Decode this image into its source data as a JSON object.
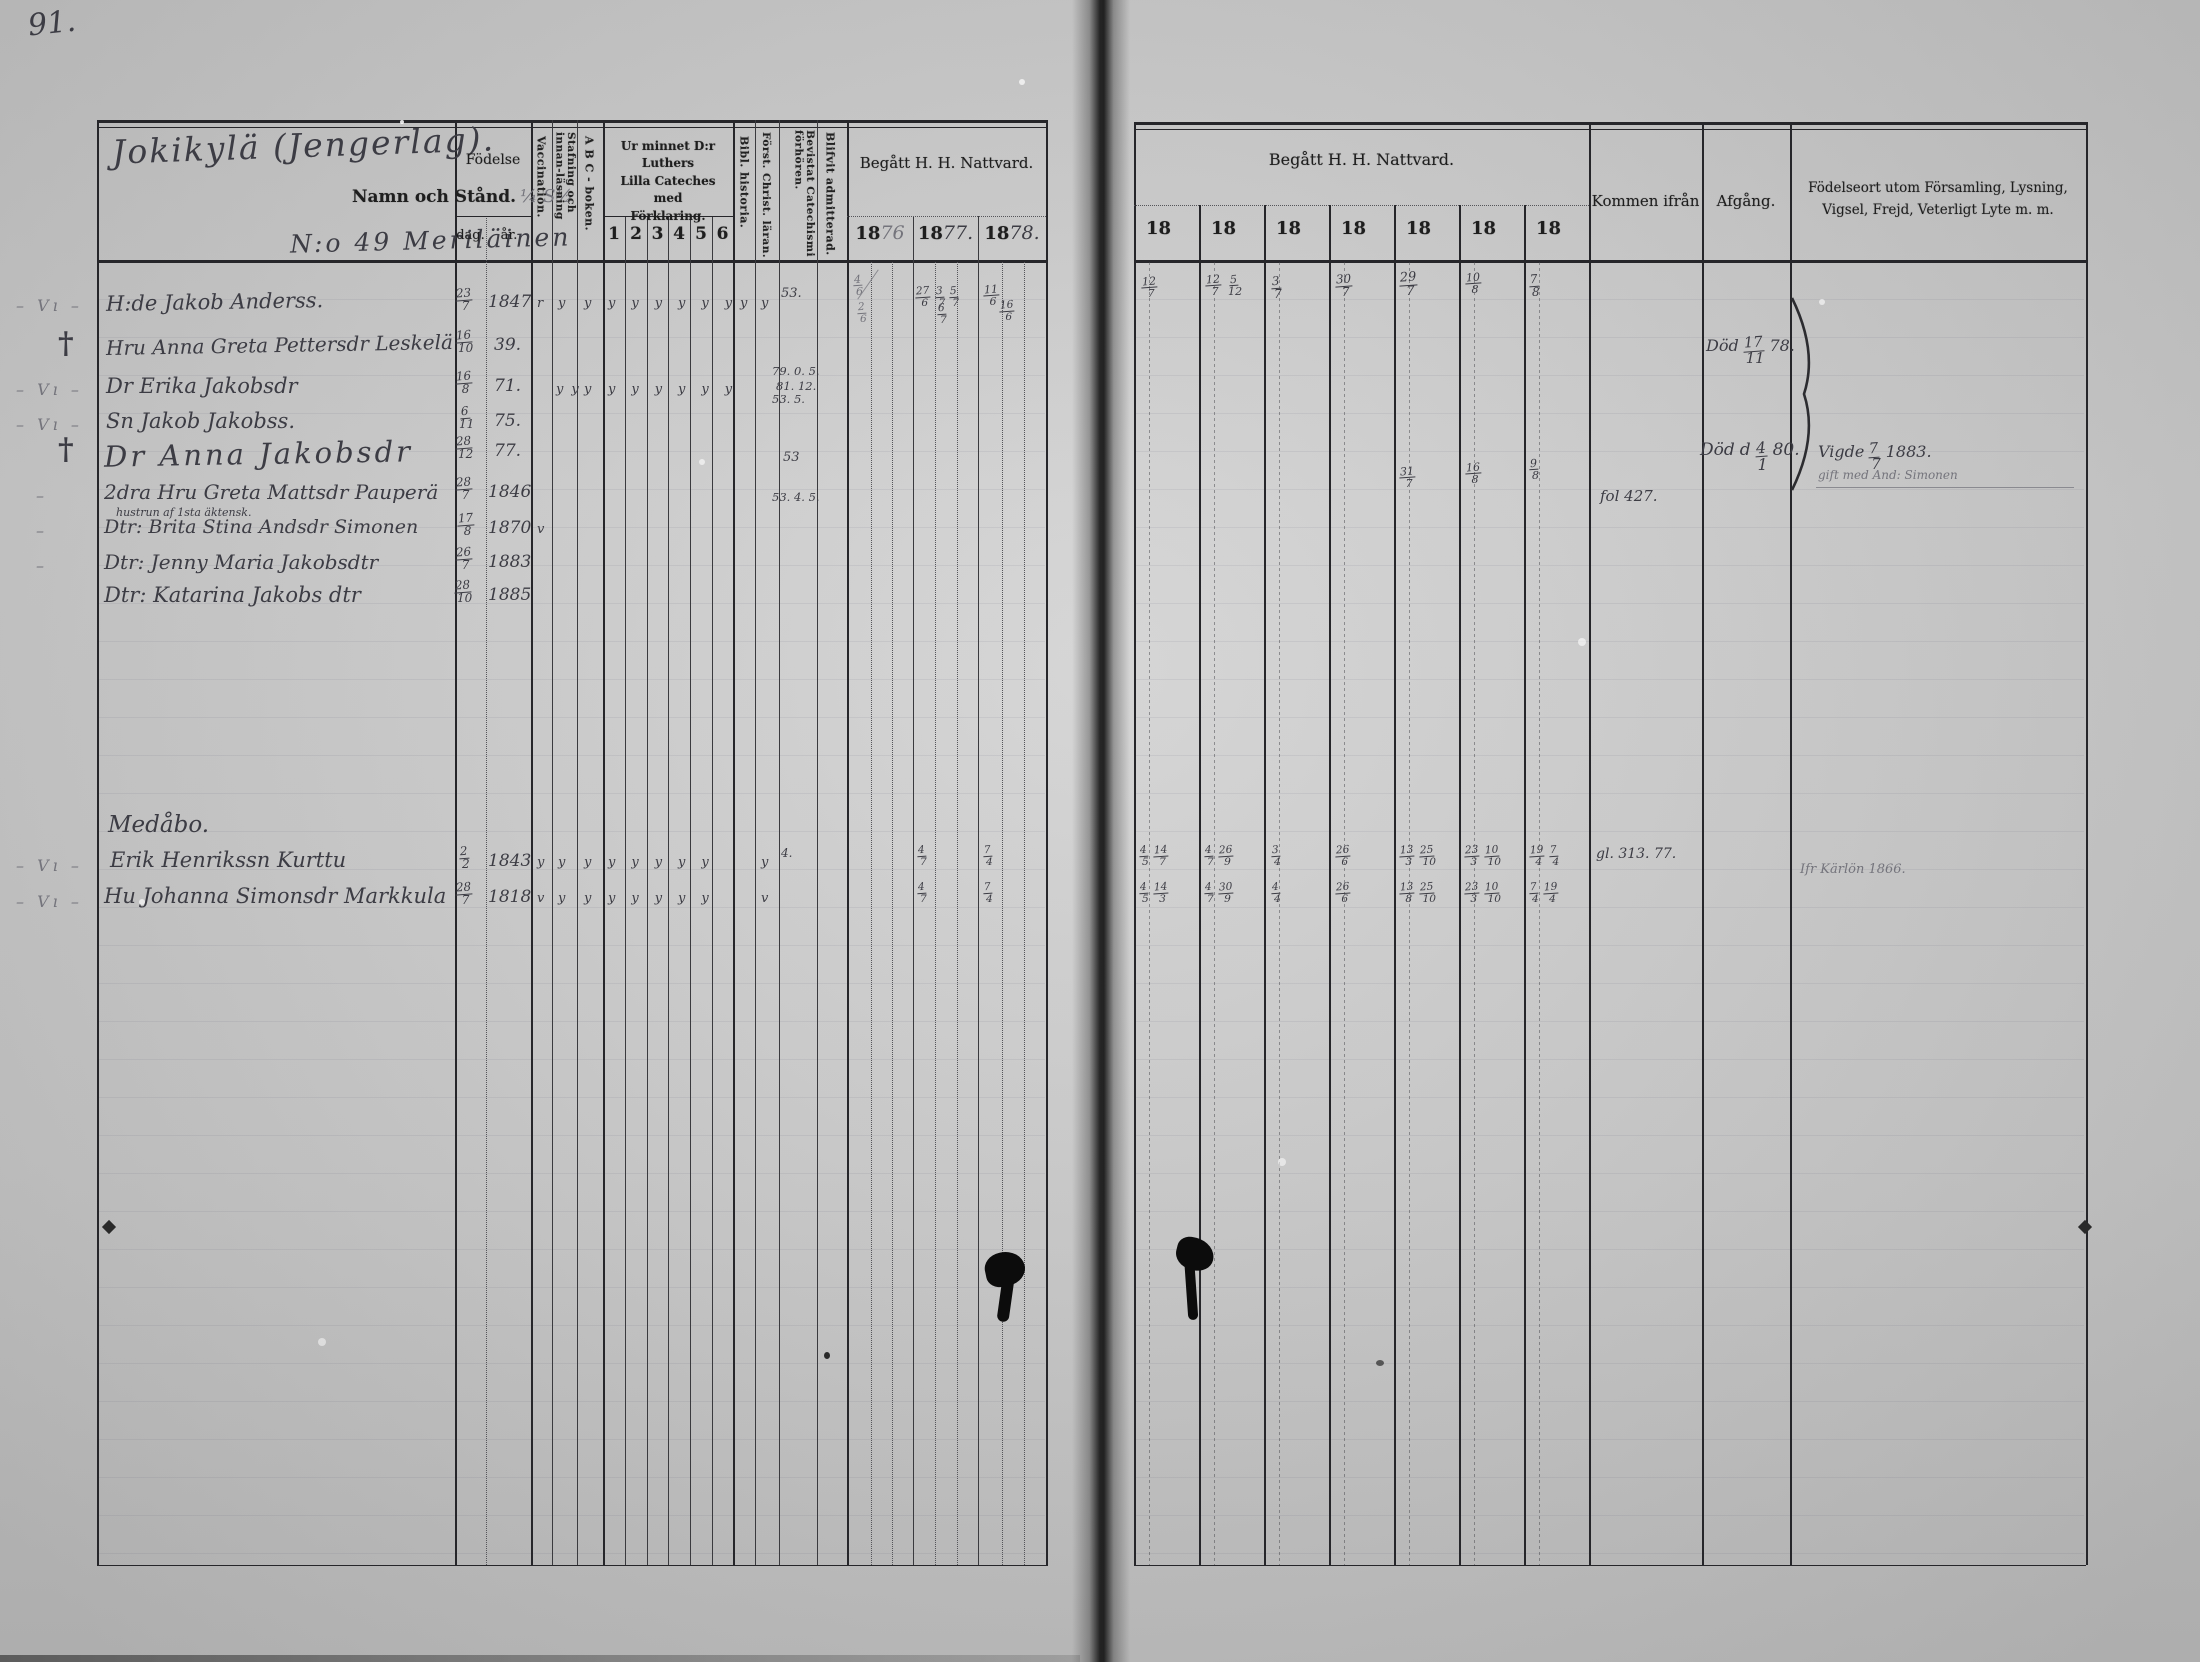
{
  "page_number": "91.",
  "colors": {
    "ink": "#3c3c44",
    "pencil": "#74747c",
    "paper": "#d0d0d0"
  },
  "left_page": {
    "title_handwritten": "Jokikylä (Jengerlag).",
    "header": {
      "name_label": "Namn och Stånd.",
      "name_annotation": "¼  S½",
      "series_handwritten": "N:o 49  Meriläinen",
      "fodelse": "Födelse",
      "dag": "dag.",
      "ar": "år.",
      "vaccination": "Vaccination.",
      "stafning": "Stafning och innan-läsning",
      "abc": "A B C - boken.",
      "cateches_line1": "Ur minnet D:r Luthers",
      "cateches_line2": "Lilla  Cateches  med",
      "cateches_line3": "Förklaring.",
      "catnums": {
        "c1": "1",
        "c2": "2",
        "c3": "3",
        "c4": "4",
        "c5": "5",
        "c6": "6"
      },
      "bibl": "Bibl.  historia.",
      "forst": "Först. Christ. läran.",
      "bevistat": "Bevistat Catechismi förhören.",
      "admitterad": "Blifvit admitterad.",
      "nattvard": "Begått  H.  H.  Nattvard.",
      "years": {
        "y1": {
          "printed": "18",
          "hand": "76"
        },
        "y2": {
          "printed": "18",
          "hand": "77."
        },
        "y3": {
          "printed": "18",
          "hand": "78."
        }
      }
    },
    "rows": [
      {
        "margin": "– Vı –",
        "name": "H:de Jakob Anderss.",
        "dag": "23/7",
        "ar": "1847",
        "vacc": "r",
        "stafn": "y",
        "abc": "y",
        "cat": "yyyyyy",
        "bibl": "y",
        "forst": "y",
        "bevistat": "53.",
        "n76": "4/6",
        "n77": "27/6 3/7 5/7",
        "n78": "11/6"
      },
      {
        "margin": "†",
        "name": "Hru Anna Greta Pettersdr Leskelä",
        "dag": "16/10",
        "ar": "39.",
        "n76": "2/6",
        "n77": "6/7",
        "n78": "16/6"
      },
      {
        "margin": "– Vı –",
        "name": "Dr Erika Jakobsdr",
        "dag": "16/8",
        "ar": "71.",
        "stafn": "yy",
        "abc": "y",
        "cat": "yyyyyy",
        "bevistat": "79. 0. 5.",
        "bevistat2": "81. 12.",
        "bevistat3": "53. 5."
      },
      {
        "margin": "– Vı –",
        "name": "Sn Jakob Jakobss.",
        "dag": "6/11",
        "ar": "75."
      },
      {
        "margin": "†",
        "name": "Dr Anna Jakobsdr",
        "dag": "28/12",
        "ar": "77.",
        "bevistat": "53"
      },
      {
        "margin": "–",
        "name": "2dra Hru Greta Mattsdr Pauperä",
        "note": "hustrun af 1sta äktensk.",
        "dag": "28/7",
        "ar": "1846",
        "bevistat": "53. 4. 5."
      },
      {
        "margin": "–",
        "name": "Dtr: Brita Stina Andsdr Simonen",
        "dag": "17/8",
        "ar": "1870",
        "vacc": "v"
      },
      {
        "margin": "–",
        "name": "Dtr: Jenny Maria Jakobsdtr",
        "dag": "26/7",
        "ar": "1883"
      },
      {
        "margin": "",
        "name": "Dtr: Katarina Jakobs dtr",
        "dag": "28/10",
        "ar": "1885"
      }
    ],
    "section_handwritten": "Medåbo.",
    "rows2": [
      {
        "margin": "– Vı –",
        "name": "Erik Henrikssn Kurttu",
        "dag": "2/2",
        "ar": "1843",
        "vacc": "y",
        "stafn": "y",
        "abc": "y",
        "cat": "yyyyy",
        "forst": "y",
        "bevistat": "4.",
        "n77": "4/7",
        "n78": "7/4"
      },
      {
        "margin": "– Vı –",
        "name": "Hu Johanna Simonsdr Markkula",
        "dag": "28/7",
        "ar": "1818",
        "vacc": "v",
        "stafn": "y",
        "abc": "y",
        "cat": "yyyyy",
        "forst": "v",
        "n77": "4/7",
        "n78": "7/4"
      }
    ]
  },
  "right_page": {
    "header": {
      "nattvard": "Begått  H.  H.  Nattvard.",
      "cols": {
        "c1": "18",
        "c2": "18",
        "c3": "18",
        "c4": "18",
        "c5": "18",
        "c6": "18",
        "c7": "18"
      },
      "kommen": "Kommen ifrån",
      "afgang": "Afgång.",
      "fodelseort_line1": "Födelseort utom Församling, Lysning,",
      "fodelseort_line2": "Vigsel, Frejd, Veterligt Lyte m. m."
    },
    "r1": {
      "c1": "12/7",
      "c2": "12/7 5/12",
      "c3": "3/7",
      "c4": "30/7",
      "c5": "29/7",
      "c6": "10/8",
      "c7": "7/8"
    },
    "r6": {
      "c5": "31/7",
      "c6": "16/8",
      "c7": "9/8"
    },
    "r10": {
      "c1": "4/5 14/7",
      "c2": "4/7 26/9",
      "c3": "3/4",
      "c4": "26/6",
      "c5": "13/3 25/10",
      "c6": "23/3 10/10",
      "c7": "19/4 7/4"
    },
    "r11": {
      "c1": "4/5 14/3",
      "c2": "4/7 30/9",
      "c3": "4/4",
      "c4": "26/6",
      "c5": "13/8 25/10",
      "c6": "23/3 10/10",
      "c7": "7/4 19/4"
    },
    "notes": {
      "dod1": "Död 17/11 78.",
      "dod2": "Död d 4/1 80.",
      "vigde": "Vigde 7/7 1883.",
      "gift": "gift med And: Simonen",
      "fol": "fol 427.",
      "gl": "gl. 313. 77.",
      "ifr": "Ifr Kärlön 1866."
    }
  }
}
